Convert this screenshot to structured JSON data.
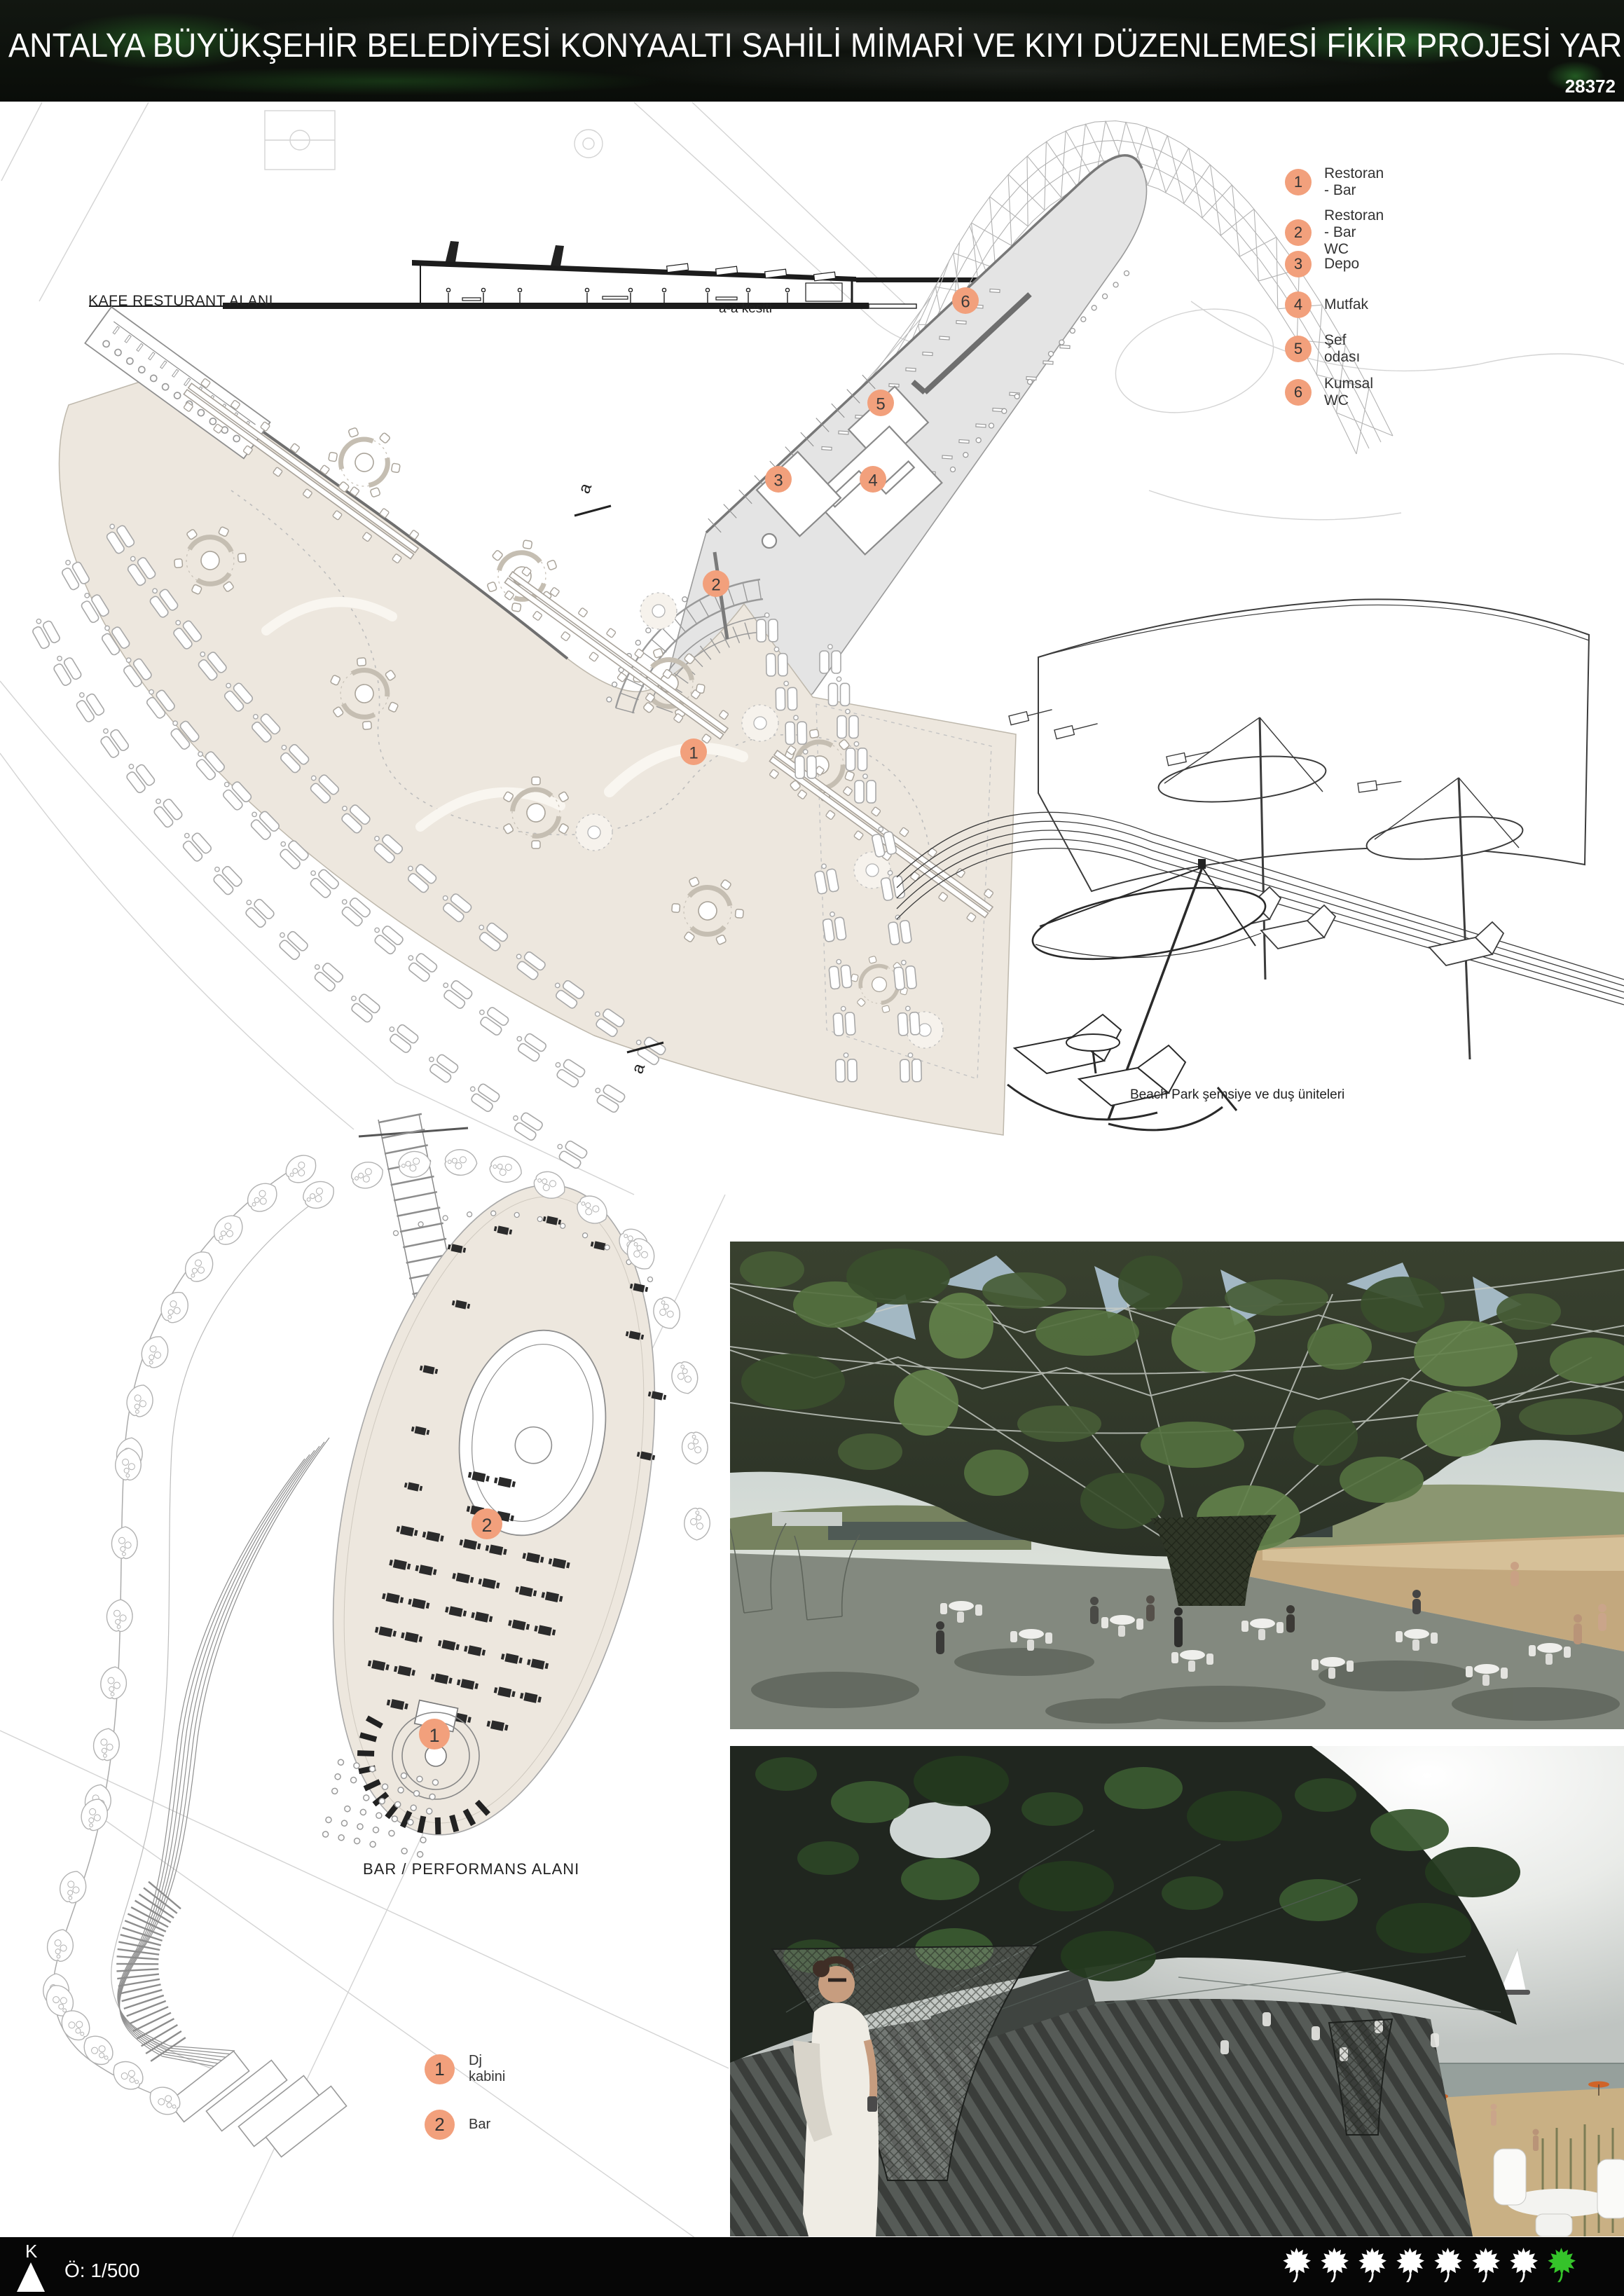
{
  "header": {
    "title": "ANTALYA BÜYÜKŞEHİR BELEDİYESİ KONYAALTI SAHİLİ MİMARİ VE KIYI DÜZENLEMESİ FİKİR PROJESİ YARIŞMASI",
    "entry_number": "28372"
  },
  "top_plan": {
    "area_label": "KAFE RESTURANT ALANI",
    "section_caption": "a-a kesiti",
    "section_cut_letter": "a",
    "legend": [
      {
        "num": "1",
        "label": "Restoran - Bar"
      },
      {
        "num": "2",
        "label": "Restoran - Bar  WC"
      },
      {
        "num": "3",
        "label": "Depo"
      },
      {
        "num": "4",
        "label": "Mutfak"
      },
      {
        "num": "5",
        "label": "Şef odası"
      },
      {
        "num": "6",
        "label": "Kumsal WC"
      }
    ],
    "markers": [
      "1",
      "2",
      "3",
      "4",
      "5",
      "6"
    ]
  },
  "beach_detail": {
    "caption": "Beach Park şemsiye ve duş üniteleri"
  },
  "bar_plan": {
    "title": "BAR / PERFORMANS ALANI",
    "legend": [
      {
        "num": "1",
        "label": "Dj kabini"
      },
      {
        "num": "2",
        "label": "Bar"
      }
    ],
    "markers": [
      "1",
      "2"
    ]
  },
  "footer": {
    "north_label": "K",
    "scale_label": "Ö: 1/500",
    "white_leaves": 7,
    "green_leaves": 1
  },
  "colors": {
    "marker_fill": "#F2A07C",
    "deck_fill": "#EDE7DE",
    "service_band_fill": "#E4E4E4",
    "leaf_white": "#FFFFFF",
    "leaf_green": "#35C32A",
    "header_bg": "#0B0F0A",
    "footer_bg": "#060606"
  }
}
